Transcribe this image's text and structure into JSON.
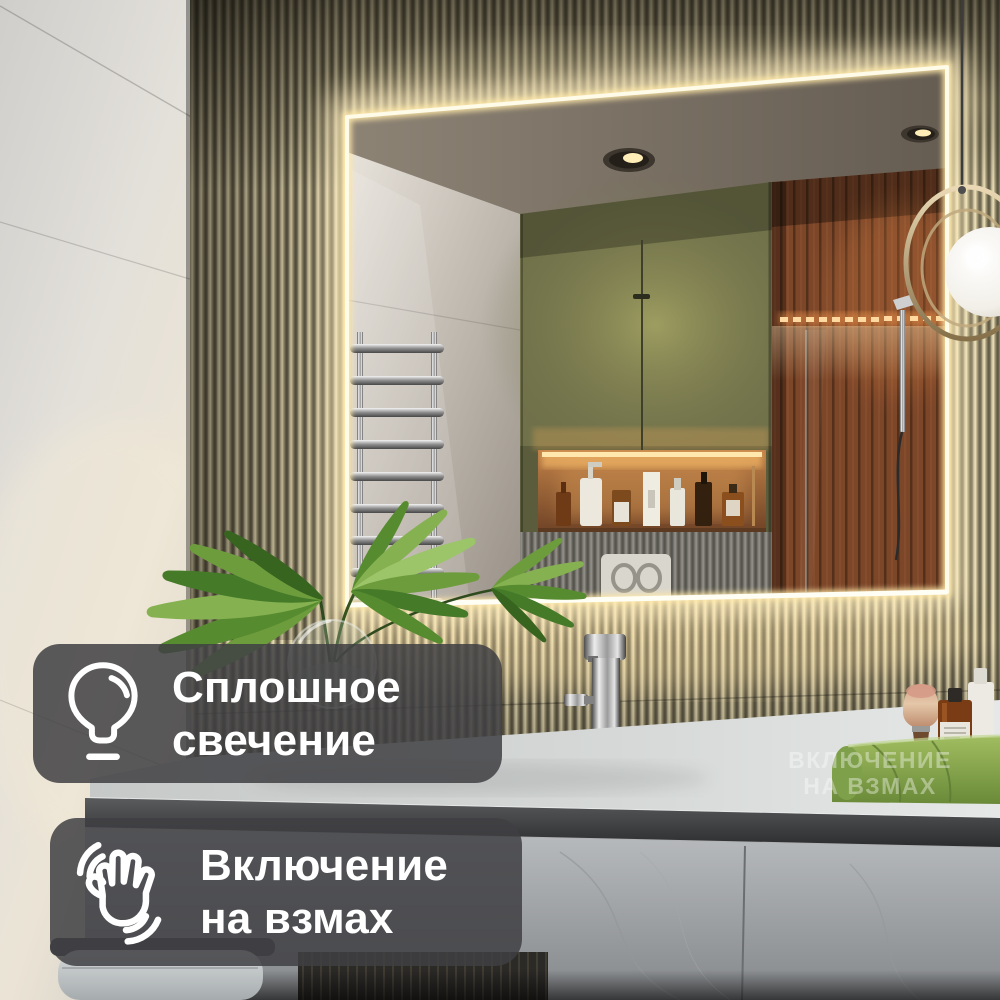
{
  "badges": [
    {
      "icon": "lightbulb-icon",
      "line1": "Сплошное",
      "line2": "свечение"
    },
    {
      "icon": "waving-hand-icon",
      "line1": "Включение",
      "line2": "на взмах"
    }
  ],
  "watermark": {
    "line1": "ВКЛЮЧЕНИЕ",
    "line2": "НА ВЗМАХ"
  },
  "colors": {
    "badge_background": "rgba(63,64,67,0.85)",
    "badge_text": "#ffffff",
    "watermark_text": "rgba(255,255,255,0.38)",
    "led_glow": "#fff6d8",
    "flute_tile": "#a89d79",
    "cabinet_green": "#70714a",
    "wood_wall": "#7c4629",
    "towel_green": "#8fae52",
    "counter_surface": "#d3d5d4"
  }
}
